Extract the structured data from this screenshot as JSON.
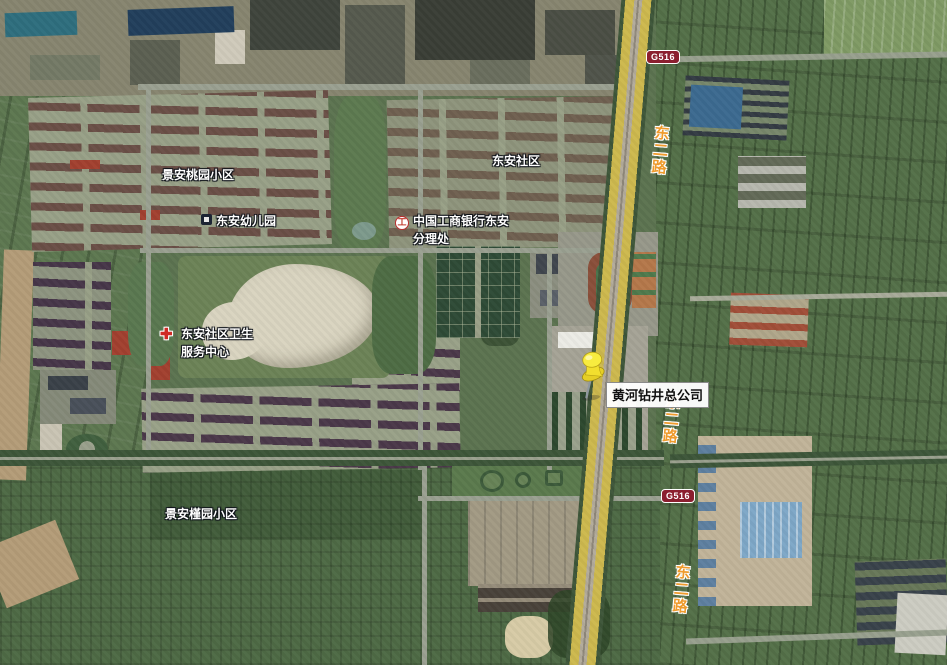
{
  "map": {
    "area_labels": {
      "taoyuan": "景安桃园小区",
      "dongan_shequ": "东安社区",
      "jinyuan": "景安槿园小区"
    },
    "poi": {
      "kindergarten": {
        "name": "东安幼儿园"
      },
      "bank": {
        "line1": "中国工商银行东安",
        "line2": "分理处",
        "glyph": "工"
      },
      "health": {
        "line1": "东安社区卫生",
        "line2": "服务中心",
        "glyph": "✚"
      },
      "company": {
        "name": "黄河钻井总公司"
      }
    },
    "roads": {
      "east2_road": "东二路",
      "badge": "G516"
    },
    "colors": {
      "highway_yellow": "#cdb94e",
      "badge_red": "#8b1f2f",
      "road_label_orange": "#ef9b2d",
      "pushpin_yellow": "#f2e032",
      "label_white": "#ffffff"
    }
  }
}
